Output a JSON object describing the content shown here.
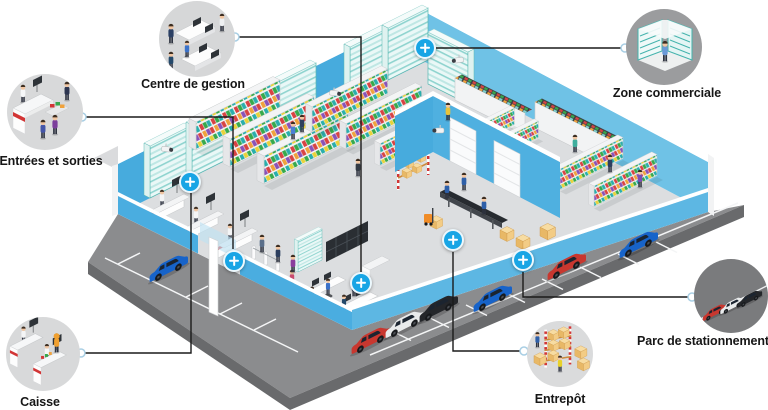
{
  "callouts": [
    {
      "id": "centre-de-gestion",
      "label": "Centre de gestion"
    },
    {
      "id": "entrees-et-sorties",
      "label": "Entrées et sorties"
    },
    {
      "id": "caisse",
      "label": "Caisse"
    },
    {
      "id": "zone-commerciale",
      "label": "Zone commerciale"
    },
    {
      "id": "entrepot",
      "label": "Entrepôt"
    },
    {
      "id": "parc-de-stationnement",
      "label": "Parc de stationnement"
    }
  ],
  "markers": [
    {
      "target": "zone-commerciale",
      "icon": "plus-icon"
    },
    {
      "target": "caisse",
      "icon": "plus-icon"
    },
    {
      "target": "entrees-et-sorties",
      "icon": "plus-icon"
    },
    {
      "target": "centre-de-gestion",
      "icon": "plus-icon"
    },
    {
      "target": "entrepot",
      "icon": "plus-icon"
    },
    {
      "target": "parc-de-stationnement",
      "icon": "plus-icon"
    }
  ],
  "icons": {
    "hotspot": "plus-icon",
    "camera": "security-camera-icon",
    "connector_dot": "link-dot-icon"
  },
  "colors": {
    "accent_blue": "#18a5e5",
    "wall_blue": "#47abdd",
    "wall_blue_light": "#5db7e3",
    "floor_gray": "#dcdee0",
    "road_gray": "#8b8c8e",
    "road_side_gray": "#696a6c",
    "callout_bg_light": "#d6d7d8",
    "callout_bg_mid": "#9b9c9e",
    "callout_bg_dark": "#7a7b7d",
    "checkout_stripe_red": "#d23535",
    "shelf_teal": "#5bb8b2",
    "box_tan": "#edbd72"
  }
}
